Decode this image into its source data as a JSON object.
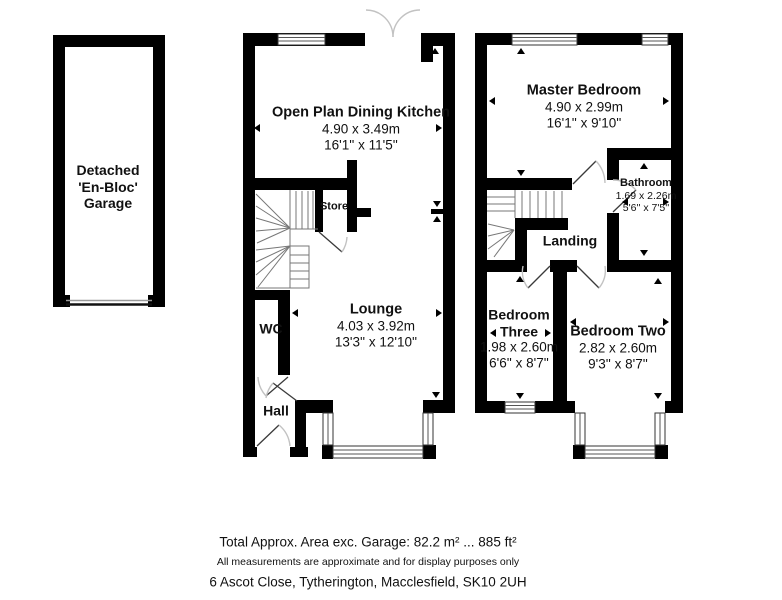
{
  "garage": {
    "line1": "Detached",
    "line2": "'En-Bloc'",
    "line3": "Garage"
  },
  "gf": {
    "kitchen": {
      "name": "Open Plan Dining Kitchen",
      "metric": "4.90 x 3.49m",
      "imperial": "16'1'' x 11'5''"
    },
    "store": {
      "name": "Store"
    },
    "lounge": {
      "name": "Lounge",
      "metric": "4.03 x 3.92m",
      "imperial": "13'3'' x 12'10''"
    },
    "wc": {
      "name": "WC"
    },
    "hall": {
      "name": "Hall"
    }
  },
  "ff": {
    "master": {
      "name": "Master Bedroom",
      "metric": "4.90 x 2.99m",
      "imperial": "16'1'' x 9'10''"
    },
    "bathroom": {
      "name": "Bathroom",
      "metric": "1.69 x 2.26m",
      "imperial": "5'6'' x 7'5''"
    },
    "landing": {
      "name": "Landing"
    },
    "bedroom_three": {
      "name": "Bedroom Three",
      "metric": "1.98 x 2.60m",
      "imperial": "6'6'' x 8'7''"
    },
    "bedroom_two": {
      "name": "Bedroom Two",
      "metric": "2.82 x 2.60m",
      "imperial": "9'3'' x 8'7''"
    }
  },
  "footer": {
    "area_line": "Total Approx. Area exc. Garage: 82.2 m² ... 885 ft²",
    "disclaimer": "All measurements are approximate and for display purposes only",
    "address": "6 Ascot Close, Tytherington, Macclesfield, SK10 2UH"
  },
  "colors": {
    "wall": "#000000",
    "door_arc": "#c2c2c2",
    "background": "#ffffff"
  }
}
